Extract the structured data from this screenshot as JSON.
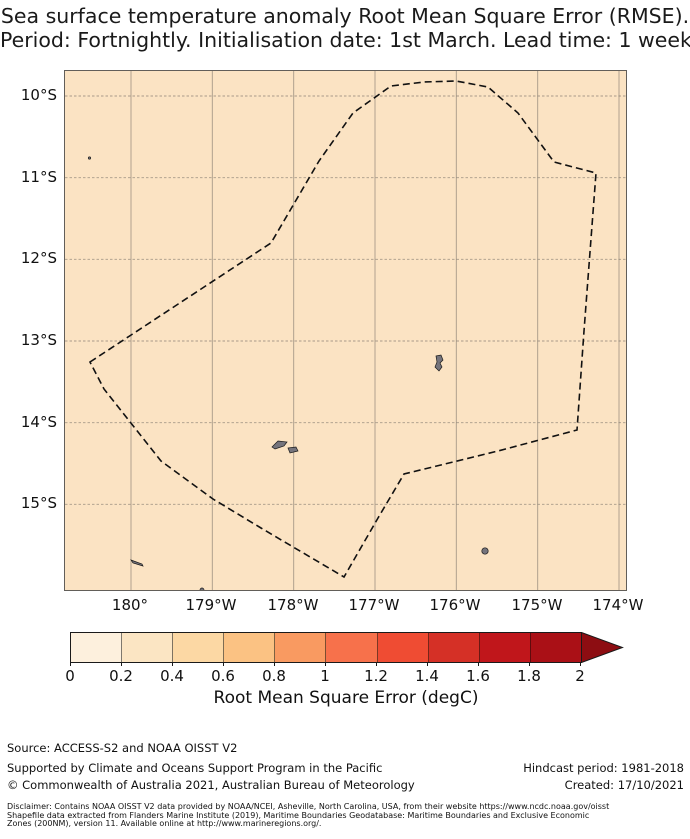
{
  "title": {
    "line1": "Sea surface temperature anomaly Root Mean Square Error (RMSE).",
    "line2": "Period: Fortnightly. Initialisation date: 1st March. Lead time: 1 week"
  },
  "map": {
    "fill_color": "#fbe3c3",
    "x_tick_labels": [
      "180°",
      "179°W",
      "178°W",
      "177°W",
      "176°W",
      "175°W",
      "174°W"
    ],
    "y_tick_labels": [
      "10°S",
      "11°S",
      "12°S",
      "13°S",
      "14°S",
      "15°S"
    ]
  },
  "colorbar": {
    "tick_labels": [
      "0",
      "0.2",
      "0.4",
      "0.6",
      "0.8",
      "1",
      "1.2",
      "1.4",
      "1.6",
      "1.8",
      "2"
    ],
    "label": "Root Mean Square Error (degC)",
    "segment_colors": [
      "#fdf0dd",
      "#fbe5c3",
      "#fcd8a4",
      "#fbc283",
      "#f99a61",
      "#f7714b",
      "#ef4c33",
      "#d53026",
      "#c0161b",
      "#aa1016"
    ],
    "over_arrow_color": "#8d0d12"
  },
  "footer": {
    "source": "Source: ACCESS-S2 and NOAA OISST V2",
    "supported": "Supported by Climate and Oceans Support Program in the Pacific",
    "hindcast": "Hindcast period: 1981-2018",
    "copyright": "© Commonwealth of Australia 2021, Australian Bureau of Meteorology",
    "created": "Created: 17/10/2021",
    "disclaimer_line1": "Disclaimer: Contains NOAA OISST V2 data provided by NOAA/NCEI, Asheville, North Carolina, USA, from their website https://www.ncdc.noaa.gov/oisst",
    "disclaimer_line2": "Shapefile data extracted from Flanders Marine Institute (2019), Maritime Boundaries Geodatabase: Maritime Boundaries and Exclusive Economic",
    "disclaimer_line3": "Zones (200NM), version 11. Available online at http://www.marineregions.org/."
  },
  "chart_data": {
    "type": "heatmap",
    "title": "Sea surface temperature anomaly Root Mean Square Error (RMSE). Period: Fortnightly. Initialisation date: 1st March. Lead time: 1 week",
    "x_ticks": [
      "180°",
      "179°W",
      "178°W",
      "177°W",
      "176°W",
      "175°W",
      "174°W"
    ],
    "y_ticks": [
      "10°S",
      "11°S",
      "12°S",
      "13°S",
      "14°S",
      "15°S"
    ],
    "lon_extent_approx": [
      "180.8°W",
      "173.9°W"
    ],
    "lat_extent_approx": [
      "9.7°S",
      "16.1°S"
    ],
    "field": "SST anomaly RMSE (degC)",
    "field_appearance": "spatially uniform pale-orange fill over whole map, value approx 0.3-0.4 degC",
    "colorbar": {
      "ticks": [
        0,
        0.2,
        0.4,
        0.6,
        0.8,
        1,
        1.2,
        1.4,
        1.6,
        1.8,
        2
      ],
      "extend": "max",
      "label": "Root Mean Square Error (degC)",
      "colors": [
        "#fdf0dd",
        "#fbe5c3",
        "#fcd8a4",
        "#fbc283",
        "#f99a61",
        "#f7714b",
        "#ef4c33",
        "#d53026",
        "#c0161b",
        "#aa1016"
      ]
    },
    "overlays": [
      "black dashed maritime (EEZ) boundary polygon",
      "small gray islands near 13.3S/176.2W, 14.3S/178W, 15.5S/175.6W, 15.7S/179.9W, 10.8S/179.9W"
    ],
    "grid": "on"
  }
}
